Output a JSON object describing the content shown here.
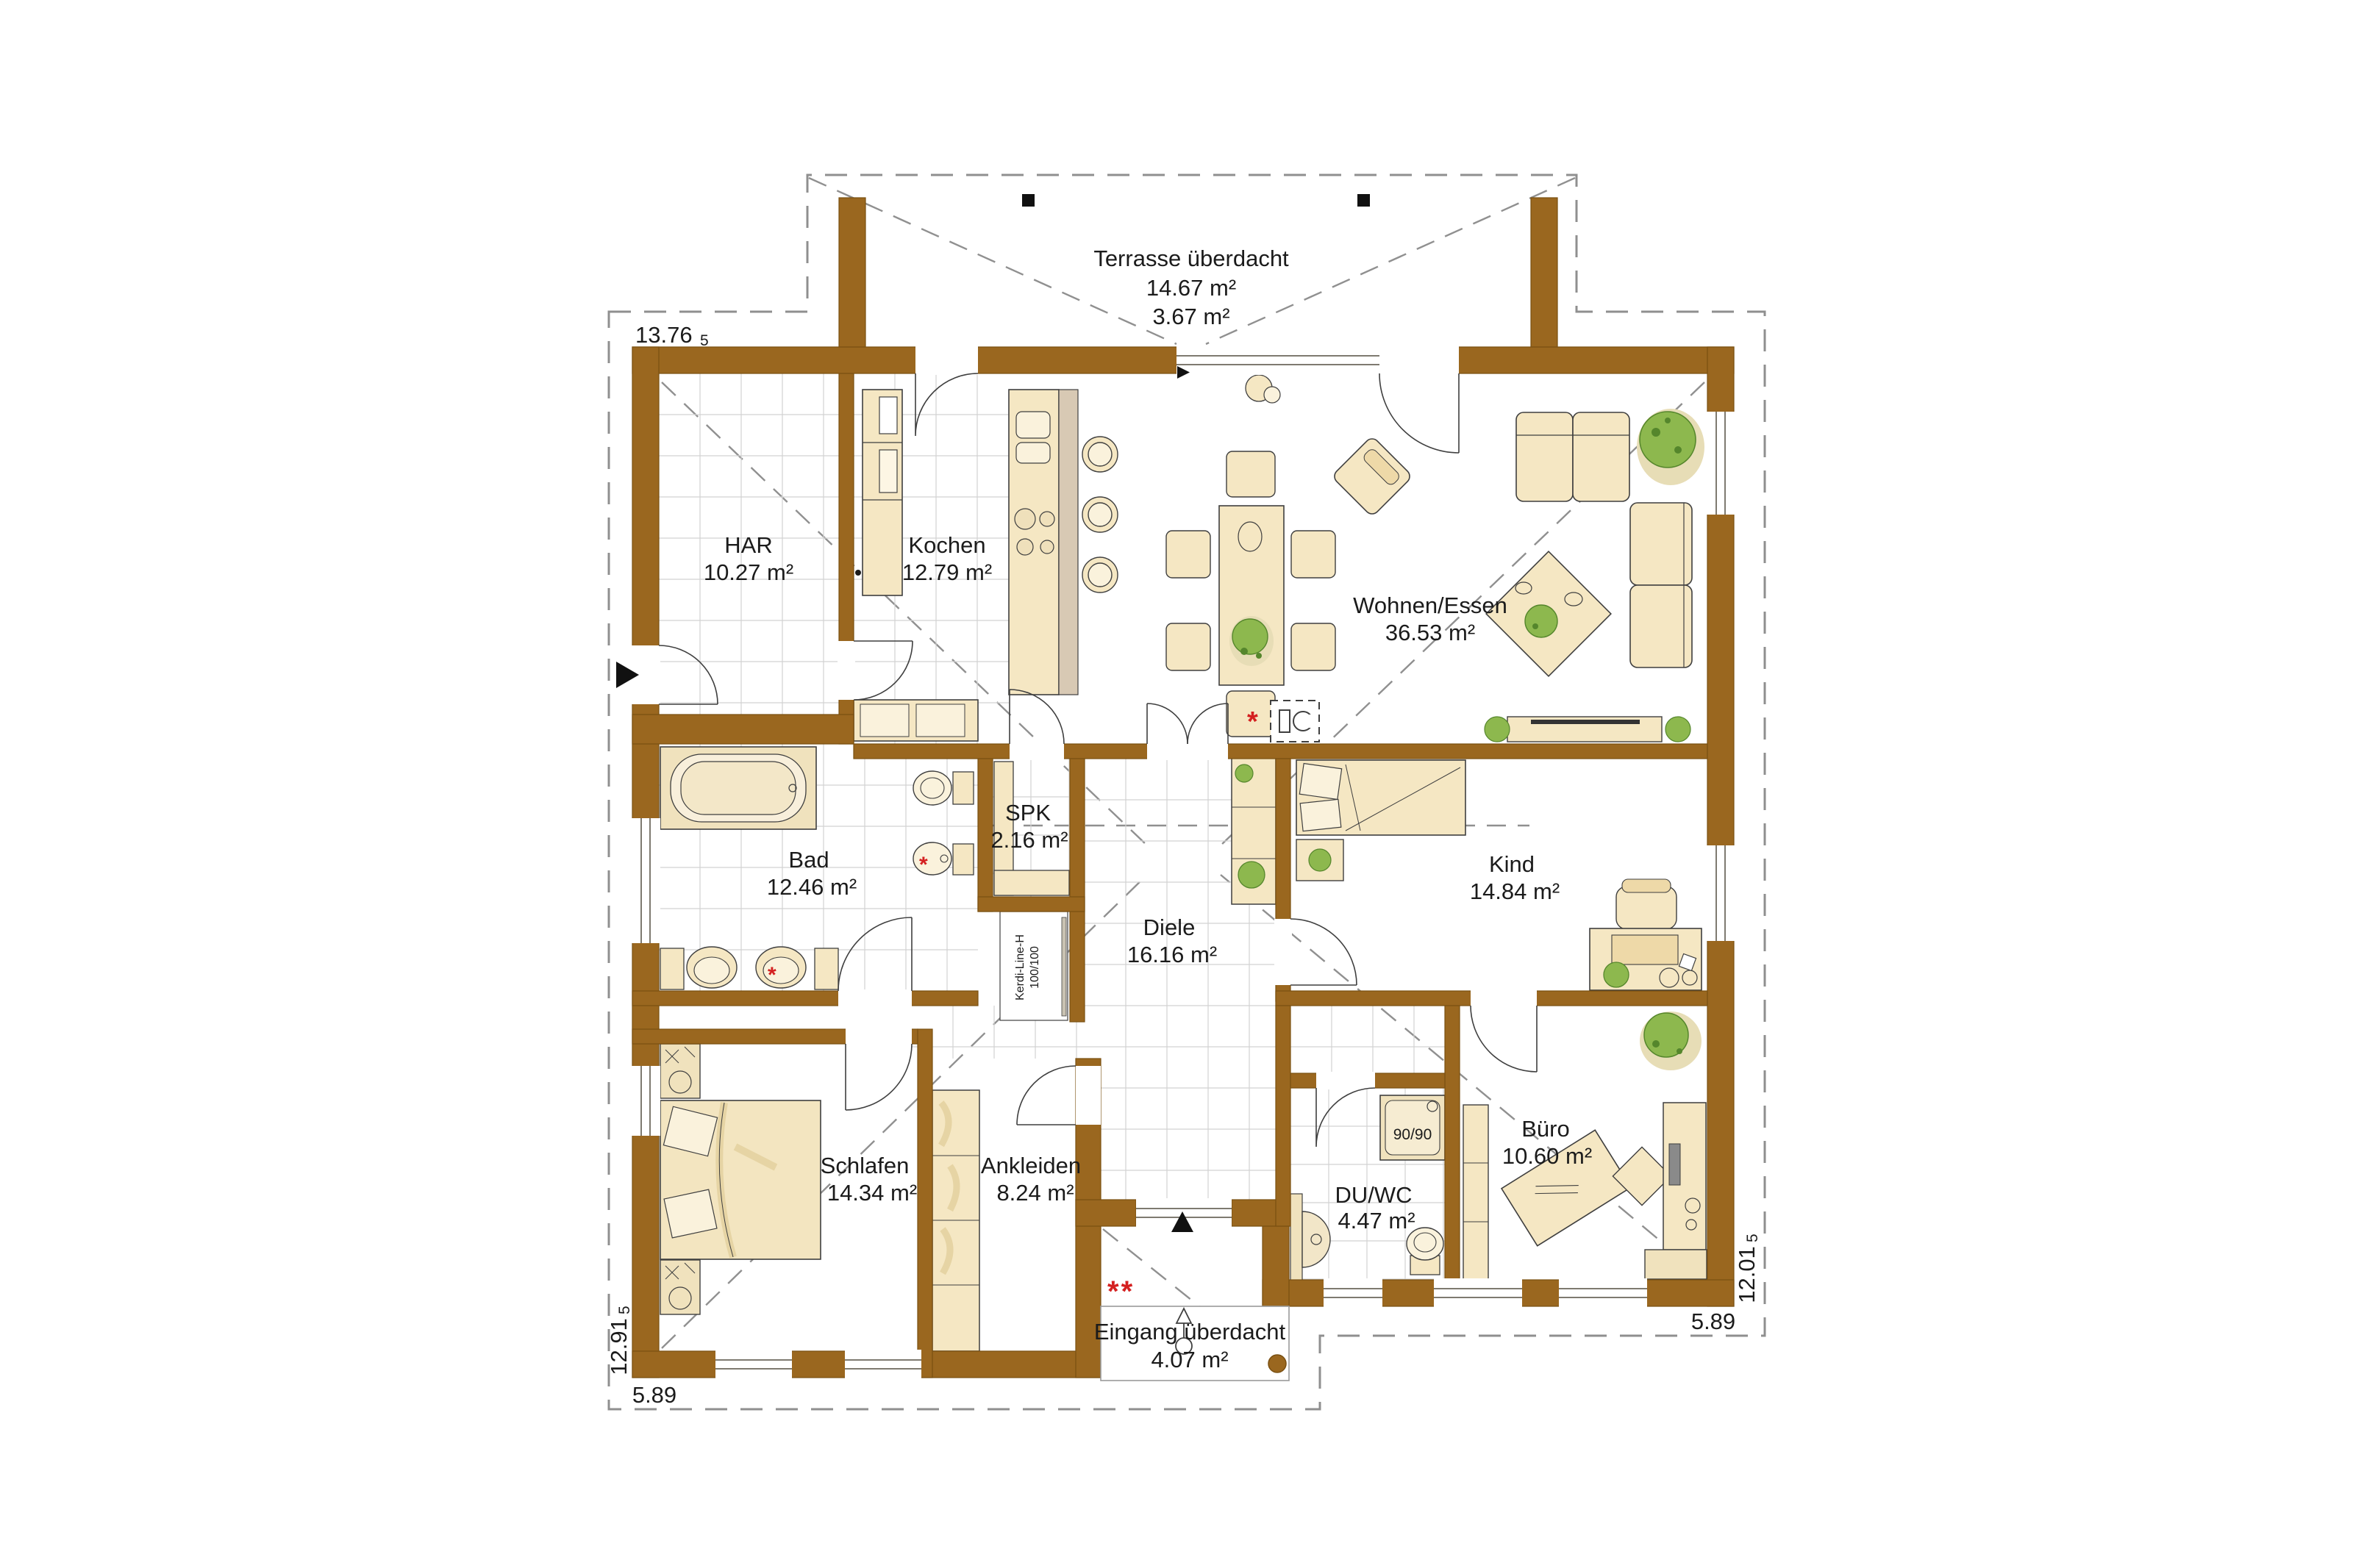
{
  "rooms": [
    {
      "id": "terrasse",
      "name": "Terrasse überdacht",
      "area": "14.67 m²",
      "area2": "3.67 m²"
    },
    {
      "id": "har",
      "name": "HAR",
      "area": "10.27 m²"
    },
    {
      "id": "kochen",
      "name": "Kochen",
      "area": "12.79 m²"
    },
    {
      "id": "wohnen",
      "name": "Wohnen/Essen",
      "area": "36.53 m²"
    },
    {
      "id": "bad",
      "name": "Bad",
      "area": "12.46 m²"
    },
    {
      "id": "spk",
      "name": "SPK",
      "area": "2.16 m²"
    },
    {
      "id": "diele",
      "name": "Diele",
      "area": "16.16 m²"
    },
    {
      "id": "kind",
      "name": "Kind",
      "area": "14.84 m²"
    },
    {
      "id": "schlafen",
      "name": "Schlafen",
      "area": "14.34 m²"
    },
    {
      "id": "ankleiden",
      "name": "Ankleiden",
      "area": "8.24 m²"
    },
    {
      "id": "duwc",
      "name": "DU/WC",
      "area": "4.47 m²"
    },
    {
      "id": "buero",
      "name": "Büro",
      "area": "10.60 m²"
    },
    {
      "id": "eingang",
      "name": "Eingang überdacht",
      "area": "4.07 m²"
    }
  ],
  "dimensions": {
    "top_left": {
      "value": "13.76",
      "sub": "5"
    },
    "left": {
      "value": "12.91",
      "sub": "5"
    },
    "bottom_left": "5.89",
    "right": {
      "value": "12.01",
      "sub": "5"
    },
    "bottom_right": "5.89"
  },
  "annotations": {
    "shower_size": "90/90",
    "drain_line_1": "Kerdi-Line-H",
    "drain_line_2": "100/100",
    "asterisk": "*",
    "double_asterisk": "**"
  },
  "icons": {
    "side_entrance_arrow": "filled-right-triangle",
    "terrace_door_arrow": "filled-right-triangle",
    "entrance_arrow": "filled-up-triangle",
    "entrance_path_arrow": "outline-up-arrow-with-circle",
    "fireplace": "stove-box-symbol",
    "terrace_post": "black-square-post",
    "porch_post": "round-brown-post"
  },
  "colors": {
    "wall": "#9a671f",
    "wall_edge": "#7a5012",
    "beige": "#f5e7c3",
    "beige_light": "#faf2dc",
    "beige_dark": "#eed9a8",
    "counter_gray": "#d8c9b4",
    "plant_green": "#8db84e",
    "plant_dark": "#55862c",
    "tile_line": "#d2d2d2",
    "dash_line": "#8f8f8f",
    "outline": "#3f3f3f",
    "red": "#d42020"
  }
}
